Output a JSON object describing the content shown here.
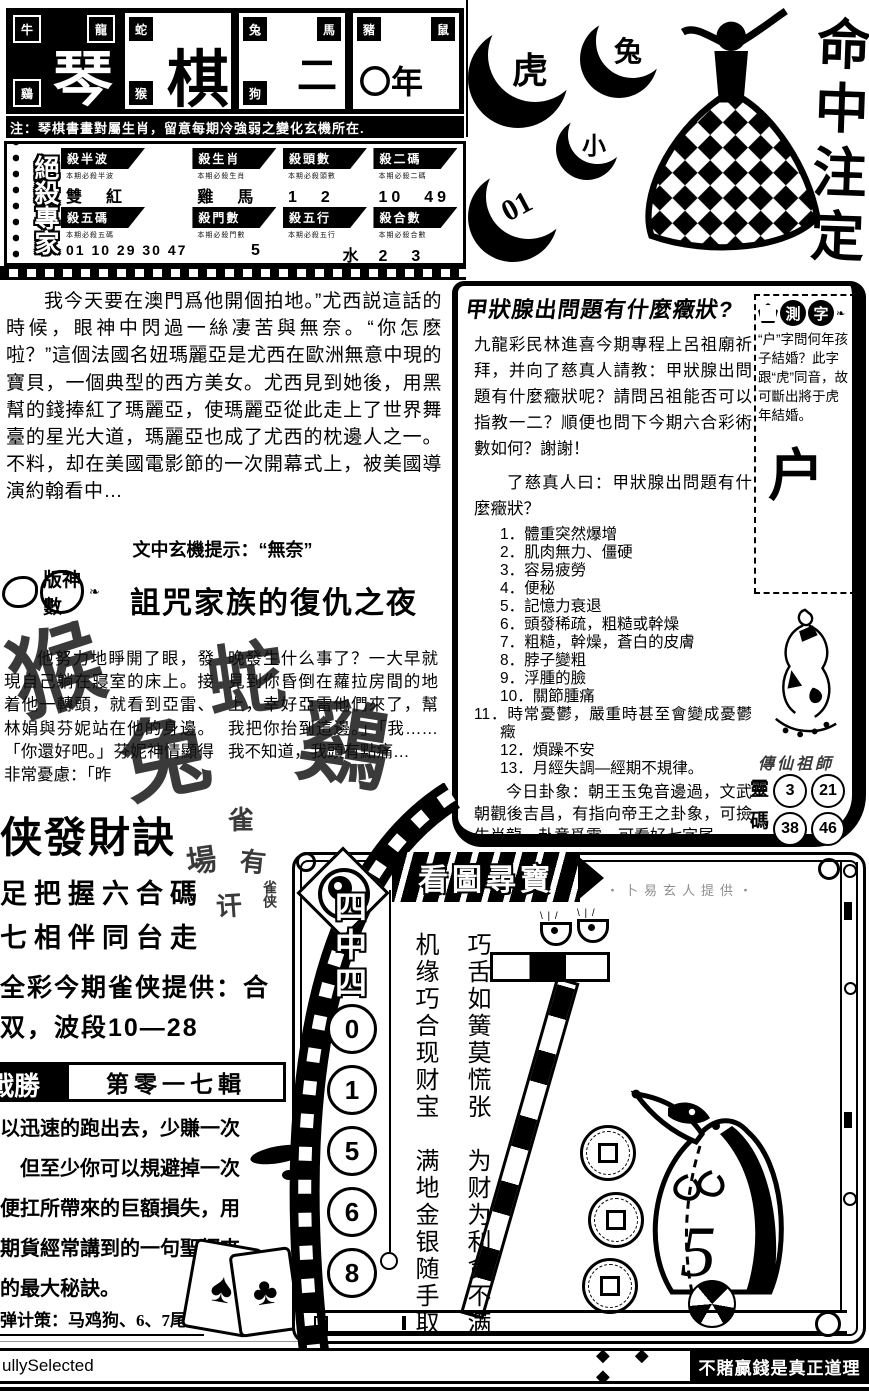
{
  "page": {
    "bg": "#ffffff",
    "ink": "#000000"
  },
  "masthead": {
    "cells": [
      {
        "big": "琴",
        "tiles": [
          "牛",
          "龍",
          "鷄"
        ]
      },
      {
        "big": "棋",
        "tiles": [
          "蛇",
          "猴"
        ]
      },
      {
        "big": "二",
        "tiles": [
          "兔",
          "馬",
          "狗"
        ]
      },
      {
        "big": "〇年",
        "tiles": [
          "豬",
          "鼠"
        ]
      }
    ],
    "note": "注：琴棋書畫對屬生肖，留意每期冷強弱之變化玄機所在."
  },
  "kill_table": {
    "logo": "絕殺專家",
    "cells": [
      {
        "header": "殺半波",
        "sub": "本期必殺半波",
        "value": "雙　紅"
      },
      {
        "header": "殺生肖",
        "sub": "本期必殺生肖",
        "value": "雞　馬"
      },
      {
        "header": "殺頭數",
        "sub": "本期必殺頭數",
        "value": "1　2"
      },
      {
        "header": "殺二碼",
        "sub": "本期必殺二碼",
        "value": "10　49"
      },
      {
        "header": "殺五碼",
        "sub": "本期必殺五碼",
        "value": "01 10 29 30 47"
      },
      {
        "header": "殺門數",
        "sub": "本期必殺門數",
        "value": "5"
      },
      {
        "header": "殺五行",
        "sub": "本期必殺五行",
        "value": "水"
      },
      {
        "header": "殺合數",
        "sub": "本期必殺合數",
        "value": "2　3"
      }
    ]
  },
  "story1": {
    "text": "我今天要在澳門爲他開個拍地。”尤西説這話的時候，眼神中閃過一絲凄苦與無奈。“你怎麽啦？”這個法國名妞瑪麗亞是尤西在歐洲無意中現的寶貝，一個典型的西方美女。尤西見到她後，用黑幫的錢捧紅了瑪麗亞，使瑪麗亞從此走上了世界舞臺的星光大道，瑪麗亞也成了尤西的枕邊人之一。不料，却在美國電影節的一次開幕式上，被美國導演約翰看中…",
    "hint": "文中玄機提示：“無奈”"
  },
  "story2": {
    "logo": "版神數",
    "title": "詛咒家族的復仇之夜",
    "col1": "他努力地睜開了眼，發現自己躺在寢室的床上。接着他一轉頭，就看到亞雷、林娟與芬妮站在他的身邊。「你還好吧。」芬妮神情顯得非常憂慮：「昨",
    "col2": "晚發生什么事了？一大早就見到你昏倒在蘿拉房間的地上，幸好亞雷他們來了，幫我把你抬到這邊。」「我……我不知道，我頭有點痛…",
    "overlay": [
      "猴",
      "蛇",
      "兔",
      "鷄"
    ]
  },
  "quexia": {
    "title": "侠發財訣",
    "marks": [
      "場",
      "雀",
      "有",
      "讦",
      "雀侠"
    ],
    "line1": "足把握六合碼",
    "line2": "七相伴同台走",
    "line3": "全彩今期雀侠提供：合",
    "line4": "双，波段10—28"
  },
  "episode": {
    "logo": "戰勝",
    "title": "第零一七輯",
    "lines": [
      "以迅速的跑出去，少賺一次",
      "但至少你可以規避掉一次",
      "便扛所帶來的巨額損失，用",
      "期貨經常講到的一句聖經來",
      "的最大秘訣。"
    ],
    "strategy": "弹计策：马鸡狗、6、7尾。"
  },
  "footer": {
    "left": "ullySelected",
    "diamonds": "◆ ◆ ◆",
    "slogan": "不賭贏錢是真正道理"
  },
  "top_right": {
    "crescents": [
      "虎",
      "兔",
      "小",
      "01"
    ],
    "calligraphy": "命中注定"
  },
  "thyroid": {
    "title": "甲狀腺出問題有什麼癥狀?",
    "para1": "九龍彩民林進喜今期專程上呂祖廟祈拜，并向了慈真人請教：甲狀腺出問題有什麼癥狀呢？請問呂祖能否可以指教一二？順便也問下今期六合彩術數如何？謝謝！",
    "para2": "了慈真人曰：甲狀腺出問題有什麼癥狀？",
    "list": [
      "1．體重突然爆增",
      "2．肌肉無力、僵硬",
      "3．容易疲勞",
      "4．便秘",
      "5．記憶力衰退",
      "6．頭發稀疏，粗糙或幹燥",
      "7．粗糙，幹燥，蒼白的皮膚",
      "8．脖子變粗",
      "9．浮腫的臉",
      "10．關節腫痛",
      "11．時常憂鬱，嚴重時甚至會變成憂鬱癥",
      "12．煩躁不安",
      "13．月經失調—經期不規律。"
    ],
    "para3": "今日卦象：朝王玉兔音邊過，文武朝觀後吉昌，有指向帝王之卦象，可撿生肖龍。卦意爲震，可看好七字尾。"
  },
  "riddle": {
    "logo_char1": "測",
    "logo_char2": "字",
    "text": "“户”字問何年孩子結婚？此字跟“虎”同音，故可斷出將于虎年結婚。",
    "big_char": "户",
    "caption": "傳仙祖師",
    "lingma_label_top": "靈",
    "lingma_label_bottom": "碼",
    "numbers": [
      "3",
      "21",
      "38",
      "46"
    ]
  },
  "treasure": {
    "banner": "看圖尋寶",
    "provider": "・卜易玄人提供・",
    "label": "四中四",
    "numbers": [
      "0",
      "1",
      "5",
      "6",
      "8"
    ],
    "poem_right": "巧舌如簧莫慌张　为财为利贪不满",
    "poem_left": "机缘巧合现财宝　满地金银随手取",
    "badger_number": "5"
  }
}
